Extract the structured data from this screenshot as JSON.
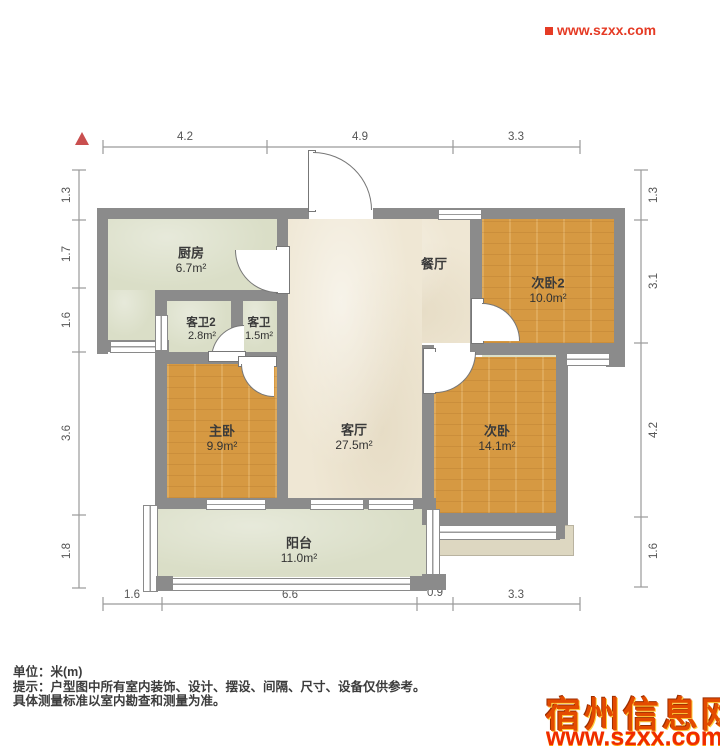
{
  "watermark_top": {
    "url": "www.szxx.com"
  },
  "watermark_bottom": {
    "site": "宿州信息网",
    "url": "www.szxx.com.cn"
  },
  "notes": {
    "unit": "单位：米(m)",
    "tip_line1": "提示：户型图中所有室内装饰、设计、摆设、间隔、尺寸、设备仅供参考。",
    "tip_line2": "具体测量标准以室内勘查和测量为准。"
  },
  "rooms": {
    "kitchen": {
      "name": "厨房",
      "area": "6.7m²"
    },
    "bath2": {
      "name": "客卫2",
      "area": "2.8m²"
    },
    "bath1": {
      "name": "客卫",
      "area": "1.5m²"
    },
    "dining": {
      "name": "餐厅"
    },
    "bedroom2b": {
      "name": "次卧2",
      "area": "10.0m²"
    },
    "master": {
      "name": "主卧",
      "area": "9.9m²"
    },
    "living": {
      "name": "客厅",
      "area": "27.5m²"
    },
    "bedroom2": {
      "name": "次卧",
      "area": "14.1m²"
    },
    "balcony": {
      "name": "阳台",
      "area": "11.0m²"
    }
  },
  "dimensions": {
    "top": [
      "4.2",
      "4.9",
      "3.3"
    ],
    "bottom": [
      "1.6",
      "6.6",
      "0.9",
      "3.3"
    ],
    "left": [
      "1.3",
      "1.7",
      "1.6",
      "3.6",
      "1.8"
    ],
    "right": [
      "1.3",
      "3.1",
      "4.2",
      "1.6"
    ]
  },
  "colors": {
    "wall": "#8b8b8b",
    "wood_floor": "#d69942",
    "cream_floor": "#efe7d4",
    "sage_floor": "#dadec7",
    "accent_red": "#e8310b",
    "dim_text": "#555555"
  }
}
